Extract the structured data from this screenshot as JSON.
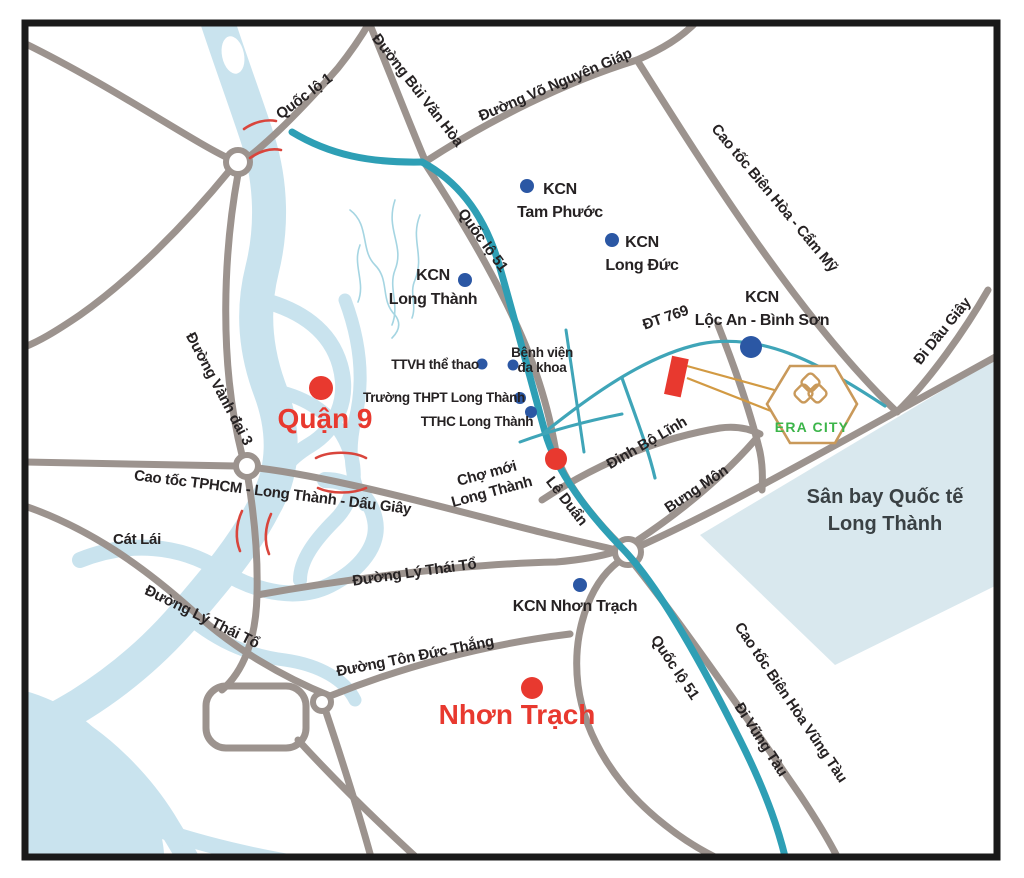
{
  "palette": {
    "river": "#c9e3ee",
    "river_line": "#a5d5e2",
    "airport_area": "#d9e8ee",
    "road_gray": "#9c938e",
    "road_teal": "#2e9fb5",
    "road_teal_thin": "#3fa5b8",
    "marker_red": "#e8392f",
    "marker_blue": "#2b57a4",
    "bridge_red": "#d9453c",
    "label_black": "#262223",
    "era_gold": "#c9995a",
    "era_green": "#3cb54a",
    "frame_black": "#1a1a1a"
  },
  "map": {
    "era_city": {
      "name": "ERA CITY",
      "logo": "era-city-hexagon-logo"
    },
    "labels": [
      {
        "id": "quoc-lo-1",
        "text": "Quốc lộ 1",
        "x": 307,
        "y": 100,
        "rot": -37,
        "cls": "road"
      },
      {
        "id": "duong-bui-van-hoa",
        "text": "Đường Bùi Văn Hòa",
        "x": 414,
        "y": 93,
        "rot": 52,
        "cls": "road"
      },
      {
        "id": "duong-vo-nguyen-giap",
        "text": "Đường Võ Nguyên Giáp",
        "x": 557,
        "y": 89,
        "rot": -23,
        "cls": "road"
      },
      {
        "id": "cao-toc-bien-hoa-cam-my",
        "text": "Cao tốc Biên Hòa - Cẩm Mỹ",
        "x": 771,
        "y": 201,
        "rot": 50,
        "cls": "road"
      },
      {
        "id": "di-dau-giay",
        "text": "Đi Dầu Giây",
        "x": 946,
        "y": 334,
        "rot": -51,
        "cls": "road"
      },
      {
        "id": "quoc-lo-51-north",
        "text": "Quốc lộ 51",
        "x": 479,
        "y": 243,
        "rot": 54,
        "cls": "road"
      },
      {
        "id": "dt-769",
        "text": "ĐT 769",
        "x": 667,
        "y": 322,
        "rot": -19,
        "cls": "road"
      },
      {
        "id": "duong-vanh-dai-3",
        "text": "Đường Vành đai 3",
        "x": 215,
        "y": 391,
        "rot": 62,
        "cls": "road"
      },
      {
        "id": "le-duan",
        "text": "Lê Duẩn",
        "x": 563,
        "y": 504,
        "rot": 52,
        "cls": "road"
      },
      {
        "id": "dinh-bo-linh",
        "text": "Đinh Bộ Lĩnh",
        "x": 649,
        "y": 447,
        "rot": -30,
        "cls": "road"
      },
      {
        "id": "bung-mon",
        "text": "Bưng Môn",
        "x": 699,
        "y": 493,
        "rot": -34,
        "cls": "road"
      },
      {
        "id": "cao-toc-tphcm-long-thanh-dau-giay",
        "text": "Cao tốc TPHCM - Long Thành - Dấu Giây",
        "x": 272,
        "y": 497,
        "rot": 7,
        "cls": "road"
      },
      {
        "id": "cat-lai",
        "text": "Cát Lái",
        "x": 137,
        "y": 544,
        "rot": 0,
        "cls": "road"
      },
      {
        "id": "duong-ly-thai-to-west",
        "text": "Đường Lý Thái Tổ",
        "x": 200,
        "y": 621,
        "rot": 26,
        "cls": "road"
      },
      {
        "id": "duong-ly-thai-to-mid",
        "text": "Đường Lý Thái Tổ",
        "x": 415,
        "y": 577,
        "rot": -8,
        "cls": "road"
      },
      {
        "id": "duong-ton-duc-thang",
        "text": "Đường Tôn Đức Thắng",
        "x": 416,
        "y": 661,
        "rot": -11,
        "cls": "road"
      },
      {
        "id": "quoc-lo-51-south",
        "text": "Quốc lộ 51",
        "x": 671,
        "y": 670,
        "rot": 56,
        "cls": "road"
      },
      {
        "id": "di-vung-tau",
        "text": "Đi Vũng Tàu",
        "x": 757,
        "y": 742,
        "rot": 57,
        "cls": "road"
      },
      {
        "id": "cao-toc-bien-hoa-vung-tau",
        "text": "Cao tốc Biên Hòa Vũng Tàu",
        "x": 787,
        "y": 705,
        "rot": 56,
        "cls": "road"
      },
      {
        "id": "kcn-tam-phuoc",
        "lines": [
          "KCN",
          "Tam Phước"
        ],
        "x": 560,
        "y": 194,
        "rot": 0,
        "cls": "poi",
        "dy": 23
      },
      {
        "id": "kcn-long-duc",
        "lines": [
          "KCN",
          "Long Đức"
        ],
        "x": 642,
        "y": 247,
        "rot": 0,
        "cls": "poi",
        "dy": 23
      },
      {
        "id": "kcn-long-thanh",
        "lines": [
          "KCN",
          "Long Thành"
        ],
        "x": 433,
        "y": 280,
        "rot": 0,
        "cls": "poi",
        "dy": 24
      },
      {
        "id": "kcn-loc-an-binh-son",
        "lines": [
          "KCN",
          "Lộc An - Bình Sơn"
        ],
        "x": 762,
        "y": 302,
        "rot": 0,
        "cls": "poi",
        "dy": 23
      },
      {
        "id": "kcn-nhon-trach",
        "text": "KCN Nhơn Trạch",
        "x": 575,
        "y": 611,
        "rot": 0,
        "cls": "poi"
      },
      {
        "id": "cho-moi-long-thanh",
        "lines": [
          "Chợ mới",
          "Long Thành"
        ],
        "x": 488,
        "y": 478,
        "rot": -15,
        "cls": "road",
        "dy": 19
      },
      {
        "id": "ttvh-the-thao",
        "text": "TTVH thể thao",
        "x": 435,
        "y": 369,
        "rot": 0,
        "cls": "small"
      },
      {
        "id": "benh-vien-da-khoa",
        "lines": [
          "Bệnh viện",
          "đa khoa"
        ],
        "x": 542,
        "y": 357,
        "rot": 0,
        "cls": "small",
        "dy": 15
      },
      {
        "id": "truong-thpt-long-thanh",
        "text": "Trường THPT Long Thành",
        "x": 444,
        "y": 402,
        "rot": 0,
        "cls": "small"
      },
      {
        "id": "tthc-long-thanh",
        "text": "TTHC Long Thành",
        "x": 477,
        "y": 426,
        "rot": 0,
        "cls": "small"
      },
      {
        "id": "quan-9",
        "text": "Quận 9",
        "x": 325,
        "y": 428,
        "rot": 0,
        "cls": "city"
      },
      {
        "id": "nhon-trach",
        "text": "Nhơn Trạch",
        "x": 517,
        "y": 724,
        "rot": 0,
        "cls": "city"
      },
      {
        "id": "san-bay-quoc-te-long-thanh",
        "lines": [
          "Sân bay Quốc tế",
          "Long Thành"
        ],
        "x": 885,
        "y": 503,
        "rot": 0,
        "cls": "airport",
        "dy": 27
      },
      {
        "id": "era-city",
        "text": "ERA CITY",
        "x": 812,
        "y": 432,
        "rot": 0,
        "cls": "brand"
      }
    ],
    "markers": [
      {
        "name": "kcn-tam-phuoc-dot",
        "type": "blue",
        "x": 527,
        "y": 186,
        "r": 7
      },
      {
        "name": "kcn-long-duc-dot",
        "type": "blue",
        "x": 612,
        "y": 240,
        "r": 7
      },
      {
        "name": "kcn-long-thanh-dot",
        "type": "blue",
        "x": 465,
        "y": 280,
        "r": 7
      },
      {
        "name": "kcn-loc-an-binh-son-dot",
        "type": "blue",
        "x": 751,
        "y": 347,
        "r": 11
      },
      {
        "name": "ttvh-the-thao-dot",
        "type": "blue",
        "x": 482,
        "y": 364,
        "r": 5.5
      },
      {
        "name": "benh-vien-da-khoa-dot",
        "type": "blue",
        "x": 513,
        "y": 365,
        "r": 5.5
      },
      {
        "name": "truong-thpt-dot",
        "type": "blue",
        "x": 520,
        "y": 398,
        "r": 6
      },
      {
        "name": "tthc-long-thanh-dot",
        "type": "blue",
        "x": 531,
        "y": 412,
        "r": 6
      },
      {
        "name": "kcn-nhon-trach-dot",
        "type": "blue",
        "x": 580,
        "y": 585,
        "r": 7
      },
      {
        "name": "quan-9-dot",
        "type": "red",
        "x": 321,
        "y": 388,
        "r": 12
      },
      {
        "name": "cho-moi-long-thanh-dot",
        "type": "red",
        "x": 556,
        "y": 459,
        "r": 11
      },
      {
        "name": "nhon-trach-dot",
        "type": "red",
        "x": 532,
        "y": 688,
        "r": 11
      }
    ]
  }
}
